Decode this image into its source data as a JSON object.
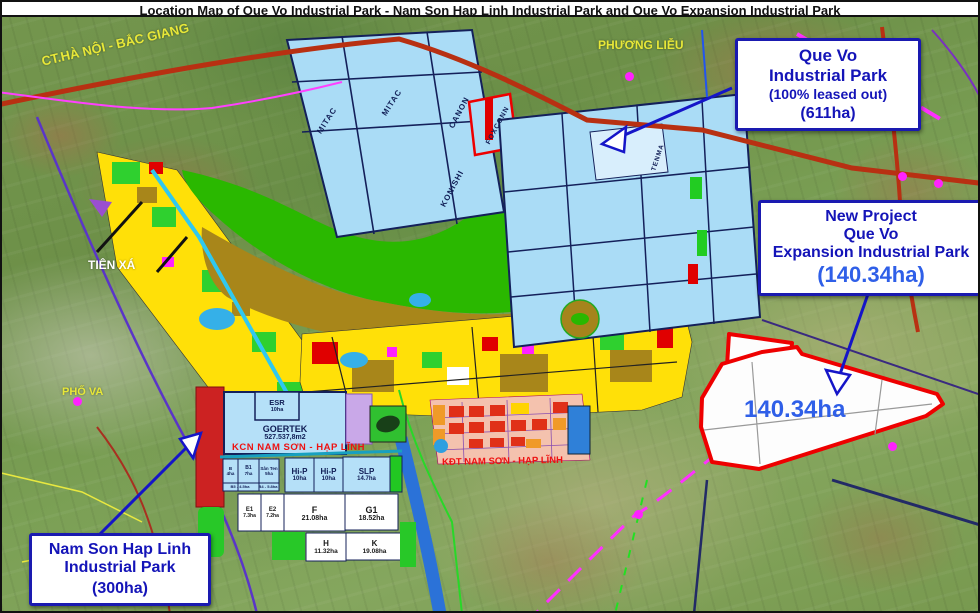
{
  "title": "Location Map of Que Vo Industrial Park - Nam Son Hap Linh Industrial Park and Que Vo Expansion Industrial Park",
  "callouts": {
    "que_vo": {
      "line1": "Que Vo",
      "line2": "Industrial Park",
      "line3": "(100% leased out)",
      "line4": "(611ha)"
    },
    "new_project": {
      "line1": "New Project",
      "line2": "Que Vo",
      "line3": "Expansion Industrial Park",
      "area": "(140.34ha)"
    },
    "nam_son": {
      "line1": "Nam Son Hap Linh",
      "line2": "Industrial Park",
      "line3": "(300ha)"
    }
  },
  "map_labels": {
    "highway": "CT.HÀ NỘI - BẮC GIANG",
    "phuong_lieu": "PHƯƠNG LIỄU",
    "tien_xa": "TIÊN XÁ",
    "pho_va": "PHỐ VA",
    "kcn_nam_son": "KCN NAM SƠN - HẠP LĨNH",
    "kdt_nam_son": "KĐT NAM SƠN - HẠP LĨNH",
    "area_140": "140.34ha"
  },
  "tenants": {
    "mitac1": "MITAC",
    "mitac2": "MITAC",
    "canon": "CANON",
    "foxconn": "FOXCONN",
    "konishi": "KONISHI",
    "tenma": "TENMA"
  },
  "parcels": {
    "goertek": {
      "name": "GOERTEK",
      "area": "527.537,8m2"
    },
    "esr": {
      "name": "ESR",
      "area": "10ha"
    },
    "b": {
      "name": "B",
      "area": "4ha"
    },
    "b1": {
      "name": "B1",
      "area": "7ha"
    },
    "san_ten": {
      "name": "Sân Ten",
      "area": "5ha"
    },
    "note1": "B5 - 4.5ha",
    "note2": "B4 - 5.8ha",
    "hip1": {
      "name": "Hi-P",
      "area": "10ha"
    },
    "hip2": {
      "name": "Hi-P",
      "area": "10ha"
    },
    "slp": {
      "name": "SLP",
      "area": "14.7ha"
    },
    "e1": {
      "name": "E1",
      "area": "7.3ha"
    },
    "e2": {
      "name": "E2",
      "area": "7.2ha"
    },
    "f": {
      "name": "F",
      "area": "21.08ha"
    },
    "g1": {
      "name": "G1",
      "area": "18.52ha"
    },
    "h": {
      "name": "H",
      "area": "11.32ha"
    },
    "k": {
      "name": "K",
      "area": "19.08ha"
    }
  },
  "colors": {
    "callout_text": "#1414b8",
    "callout_border": "#1a1ab0",
    "area_text": "#2f5fe8",
    "parcel_blue": "#aadcf6",
    "zone_yellow": "#ffe008",
    "zone_olive": "#a8861a",
    "zone_green": "#2ab800",
    "red_outline": "#ee0000",
    "label_yellow": "#e8e838",
    "road_red": "#b83012",
    "road_magenta": "#ff30ff"
  }
}
